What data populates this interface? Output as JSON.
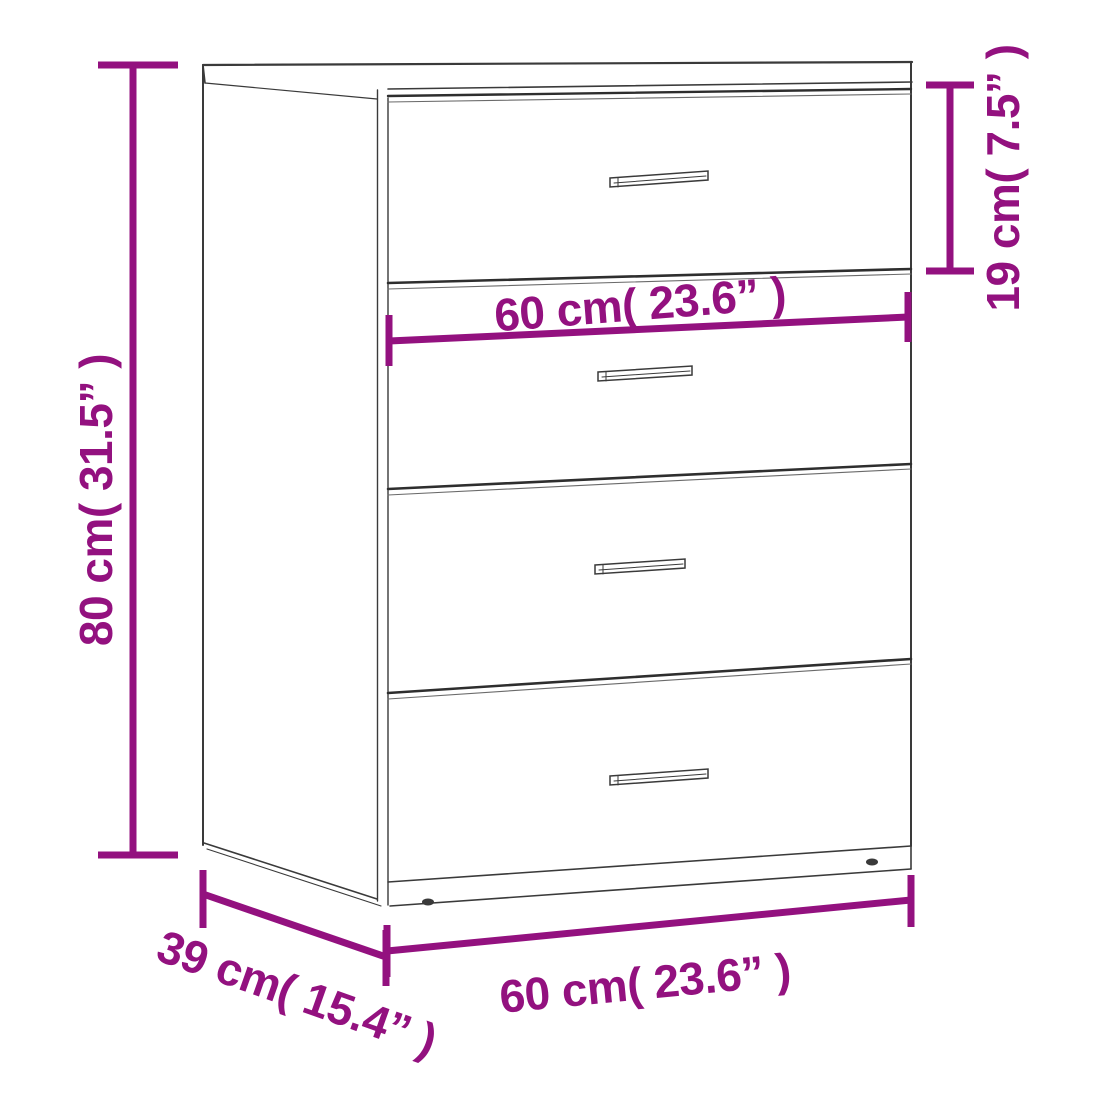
{
  "palette": {
    "dimension_color": "#93117f",
    "line_color": "#3a3a3a",
    "background": "#ffffff"
  },
  "diagram": {
    "subject": "four-drawer cabinet outline drawing",
    "drawer_count": 4,
    "dimensions": {
      "height": {
        "label": "80 cm( 31.5” )",
        "cm": 80,
        "inches": 31.5,
        "orientation": "vertical-left"
      },
      "top_drawer_height": {
        "label": "19 cm( 7.5” )",
        "cm": 19,
        "inches": 7.5,
        "orientation": "vertical-right"
      },
      "width_middle": {
        "label": "60 cm( 23.6” )",
        "cm": 60,
        "inches": 23.6,
        "orientation": "horizontal-middle"
      },
      "width_bottom": {
        "label": "60 cm( 23.6” )",
        "cm": 60,
        "inches": 23.6,
        "orientation": "horizontal-bottom"
      },
      "depth": {
        "label": "39 cm( 15.4” )",
        "cm": 39,
        "inches": 15.4,
        "orientation": "diagonal-bottom-left"
      }
    }
  }
}
